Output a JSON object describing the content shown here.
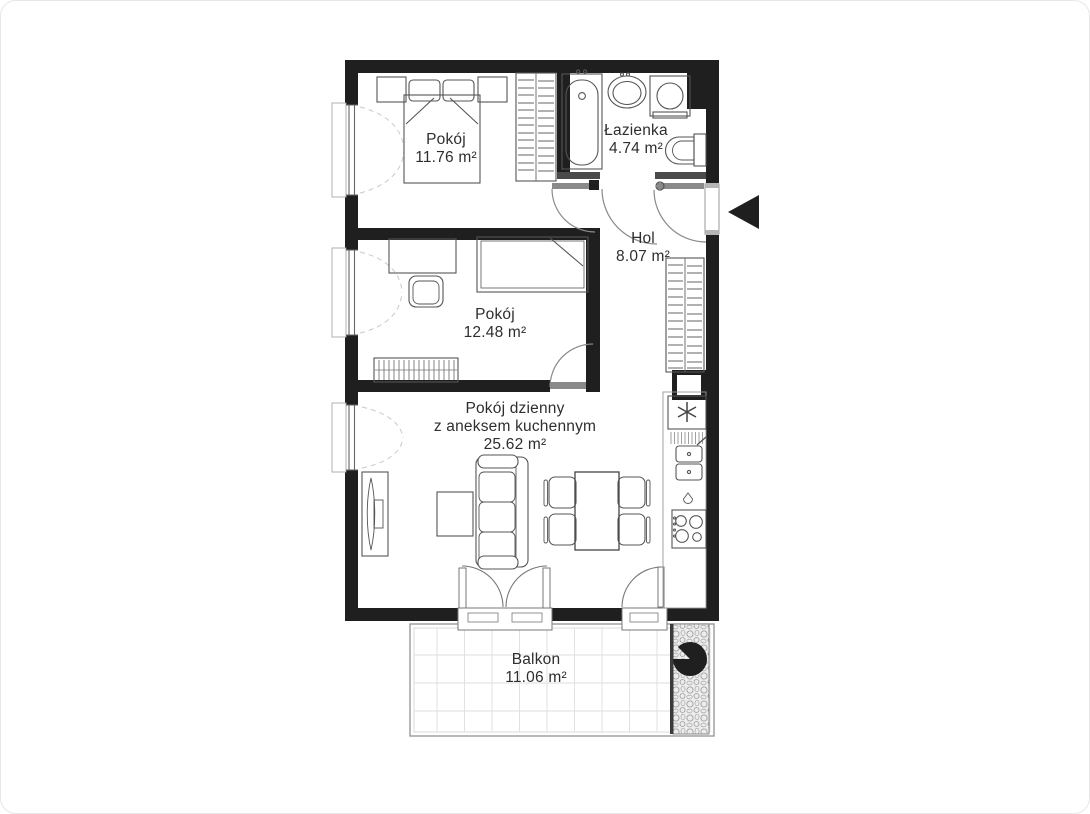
{
  "canvas": {
    "width": 1090,
    "height": 814,
    "background": "#ffffff"
  },
  "colors": {
    "wall": "#1f1f1f",
    "partition": "#4a4a4a",
    "door_line": "#8a8a8a",
    "furniture_line": "#555555",
    "grid_line": "#dedede",
    "text": "#2e2e2e"
  },
  "icons": {
    "entrance_arrow_icon": "◀",
    "fridge_snowflake_icon": "✳",
    "balcony_pinwheel_icon": "✢"
  },
  "rooms": [
    {
      "name": "Pokój",
      "area": "11.76 m²"
    },
    {
      "name": "Łazienka",
      "area": "4.74 m²"
    },
    {
      "name": "Hol",
      "area": "8.07 m²"
    },
    {
      "name": "Pokój",
      "area": "12.48 m²"
    },
    {
      "name": "Pokój dzienny",
      "name_line2": "z aneksem kuchennym",
      "area": "25.62 m²"
    },
    {
      "name": "Balkon",
      "area": "11.06 m²"
    }
  ],
  "fixtures": [
    "double-bed",
    "nightstands",
    "wardrobe",
    "bathtub",
    "washbasin",
    "washing-machine",
    "toilet",
    "hall-wardrobe",
    "desk",
    "desk-chair",
    "single-bed",
    "dresser",
    "tv",
    "coffee-table",
    "sofa",
    "dining-table",
    "dining-chairs",
    "fridge",
    "dish-rack",
    "kitchen-sink",
    "stove",
    "balcony-screen"
  ]
}
